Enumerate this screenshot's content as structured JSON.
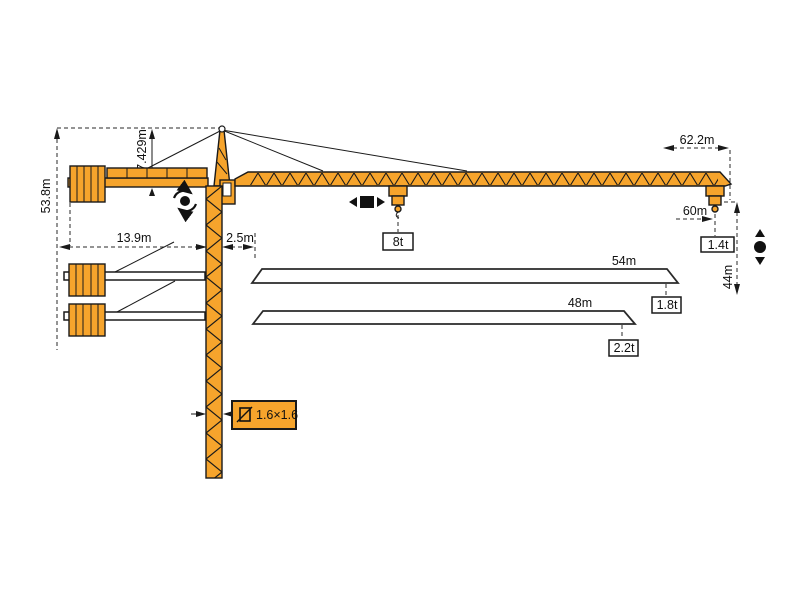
{
  "diagram": {
    "name": "tower-crane-dimension-and-capacity-diagram",
    "colors": {
      "crane_orange": "#F6A42C",
      "outline_black": "#1A1A1A",
      "background": "#FFFFFF",
      "white_fill": "#FFFFFF"
    },
    "labels": {
      "tower_height": "53.8m",
      "top_section_height": "7.429m",
      "counterjib_length": "13.9m",
      "jib_root_offset": "2.5m",
      "max_jib_span": "62.2m",
      "tip_radius": "60m",
      "hook_height": "44m",
      "capacity_mid": "8t",
      "capacity_tip_60": "1.4t",
      "mast_section": "1.6×1.6"
    },
    "jib_variants": [
      {
        "length": "54m",
        "tip_load": "1.8t"
      },
      {
        "length": "48m",
        "tip_load": "2.2t"
      }
    ],
    "icons": {
      "slew": "slew-rotation-icon",
      "trolley": "trolley-travel-icon",
      "hoist": "hoist-up-down-icon",
      "section": "mast-section-icon"
    }
  }
}
